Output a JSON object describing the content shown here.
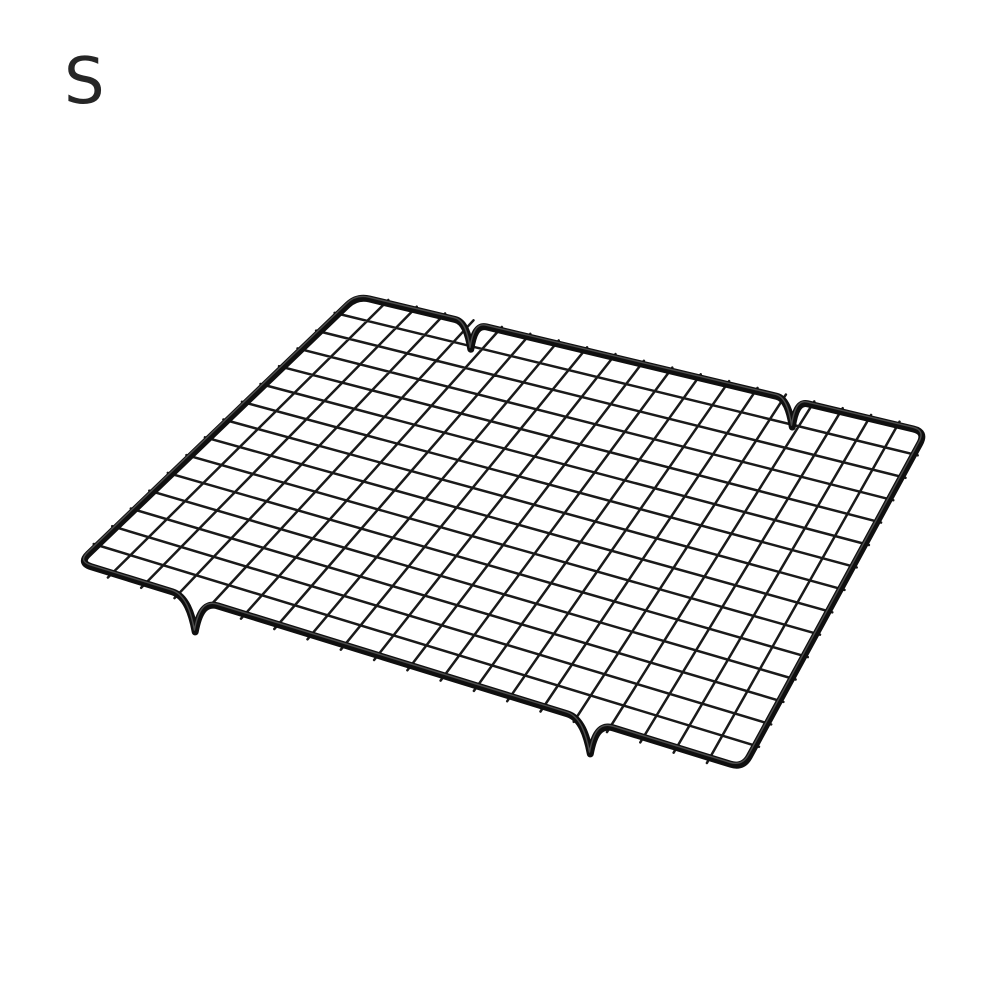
{
  "page": {
    "background_color": "#ffffff",
    "width_px": 1000,
    "height_px": 1000
  },
  "size_label": {
    "text": "S",
    "color": "#262626"
  },
  "product_image": {
    "alt": "Black non-stick metal wire baking cooling rack grid shown in perspective on a white background",
    "wire_color": "#1a1a1a",
    "frame_color": "#0f0f0f",
    "frame_highlight_color": "#777777",
    "frame_stroke_px": 7,
    "frame_highlight_stroke_px": 1.4,
    "grid_stroke_px": 2.5,
    "corner_radius_px": 13,
    "corners": {
      "back_left": [
        357,
        296
      ],
      "back_right": [
        926,
        432
      ],
      "front_right": [
        743,
        768
      ],
      "front_left": [
        79,
        563
      ]
    },
    "grid": {
      "column_wires": 19,
      "row_wires": 14,
      "overhang_back_px": 4,
      "overhang_front_px": 6,
      "overhang_side_px": 4
    },
    "feet_notches": {
      "_comment": "t is the fraction along the edge in drawing direction: back edge runs back_left->back_right, front edge runs front_right->front_left; depth is how far the foot dip hangs below the edge in px",
      "back_edge": [
        {
          "t": 0.2,
          "half_width_px": 16,
          "depth_px": 26
        },
        {
          "t": 0.765,
          "half_width_px": 16,
          "depth_px": 27
        }
      ],
      "front_edge": [
        {
          "t": 0.23,
          "half_width_px": 24,
          "depth_px": 33
        },
        {
          "t": 0.825,
          "half_width_px": 24,
          "depth_px": 33
        }
      ]
    }
  }
}
